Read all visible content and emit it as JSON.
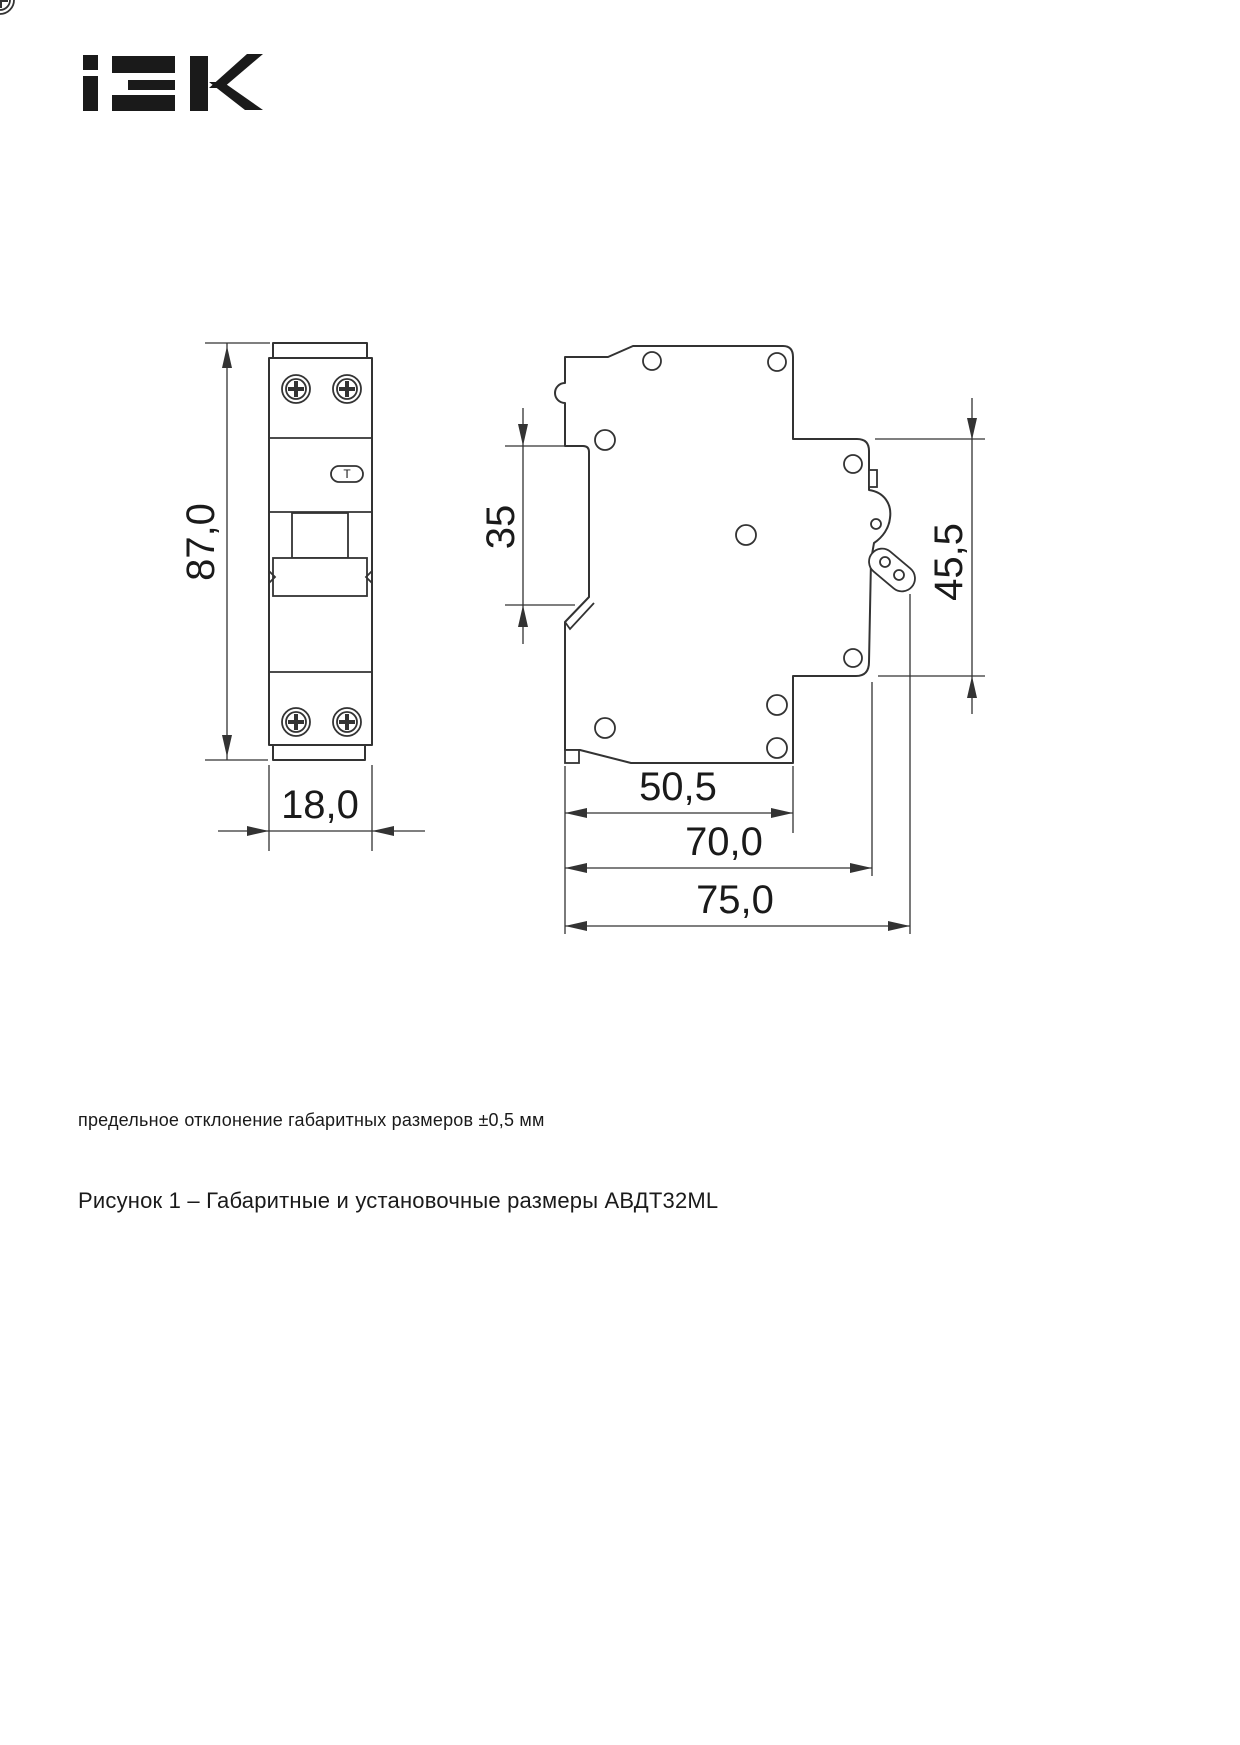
{
  "logo": {
    "brand": "IEK"
  },
  "drawing": {
    "front_view": {
      "overall_height": "87,0",
      "module_width": "18,0",
      "test_button": "T"
    },
    "side_view": {
      "din_rail_width": "35",
      "front_section_height": "45,5",
      "base_depth": "50,5",
      "depth_to_lever": "70,0",
      "overall_depth": "75,0"
    }
  },
  "note": "предельное отклонение габаритных размеров ±0,5 мм",
  "caption": "Рисунок 1 – Габаритные и установочные размеры АВДТ32ML",
  "colors": {
    "line": "#333333",
    "text": "#1a1a1a",
    "background": "#ffffff"
  }
}
